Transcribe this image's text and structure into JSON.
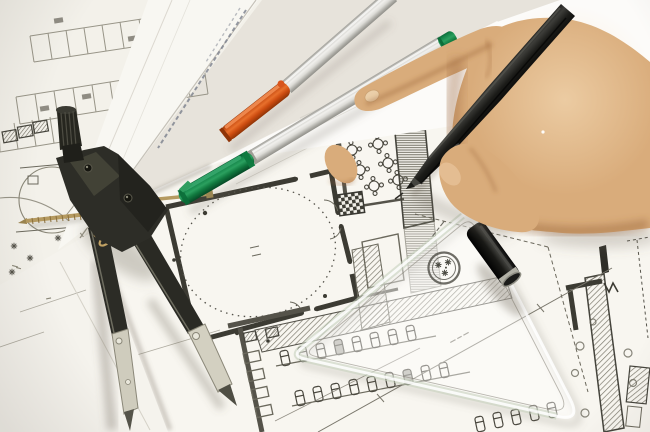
{
  "scene": {
    "objects": [
      {
        "name": "overlapping blueprint sheets",
        "color": "#f8f6f0"
      },
      {
        "name": "site plan with parking rows",
        "color": "#989588"
      },
      {
        "name": "floor plan with round tables and hatched walls",
        "color": "#3c3b33"
      },
      {
        "name": "drafting compass",
        "color": "#2d2d27"
      },
      {
        "name": "orange-capped marker pen",
        "color": "#d8551d"
      },
      {
        "name": "green-capped marker pen",
        "color": "#17914f"
      },
      {
        "name": "black drawing pen",
        "color": "#1b1b18"
      },
      {
        "name": "black pen cap",
        "color": "#111110"
      },
      {
        "name": "transparent triangle ruler with round stamp",
        "color": "rgba(255,255,255,0.4)"
      },
      {
        "name": "right hand holding pen",
        "color": "#d9ac7b"
      }
    ]
  },
  "palette": {
    "paper_base": "#e7e3db",
    "sheet_siteplan": "#f3f1ea",
    "sheet_strip": "#f8f7f2",
    "sheet_main": "#f8f6f0",
    "sheet_blank": "#f5f3ed",
    "sheet_white": "#fcfbf9",
    "drawing_ink": "#55534a",
    "drawing_ink_faint": "#989588",
    "wall_dark": "#3c3b33",
    "compass_dark": "#2d2d27",
    "compass_metal": "#cfccbd",
    "brass": "#b59a60",
    "pen_silver_collar": "#9e9d95",
    "cap_orange": "#d8551d",
    "clip_orange": "#ef8a50",
    "cap_green": "#17914f",
    "clip_green": "#36a56b",
    "pen_black": "#1b1b18",
    "cap_black_ring": "#b2b1a6",
    "skin": "#d9ac7b",
    "nail": "#eed3ae",
    "ruler_glass": "rgba(255,255,255,0.42)"
  }
}
